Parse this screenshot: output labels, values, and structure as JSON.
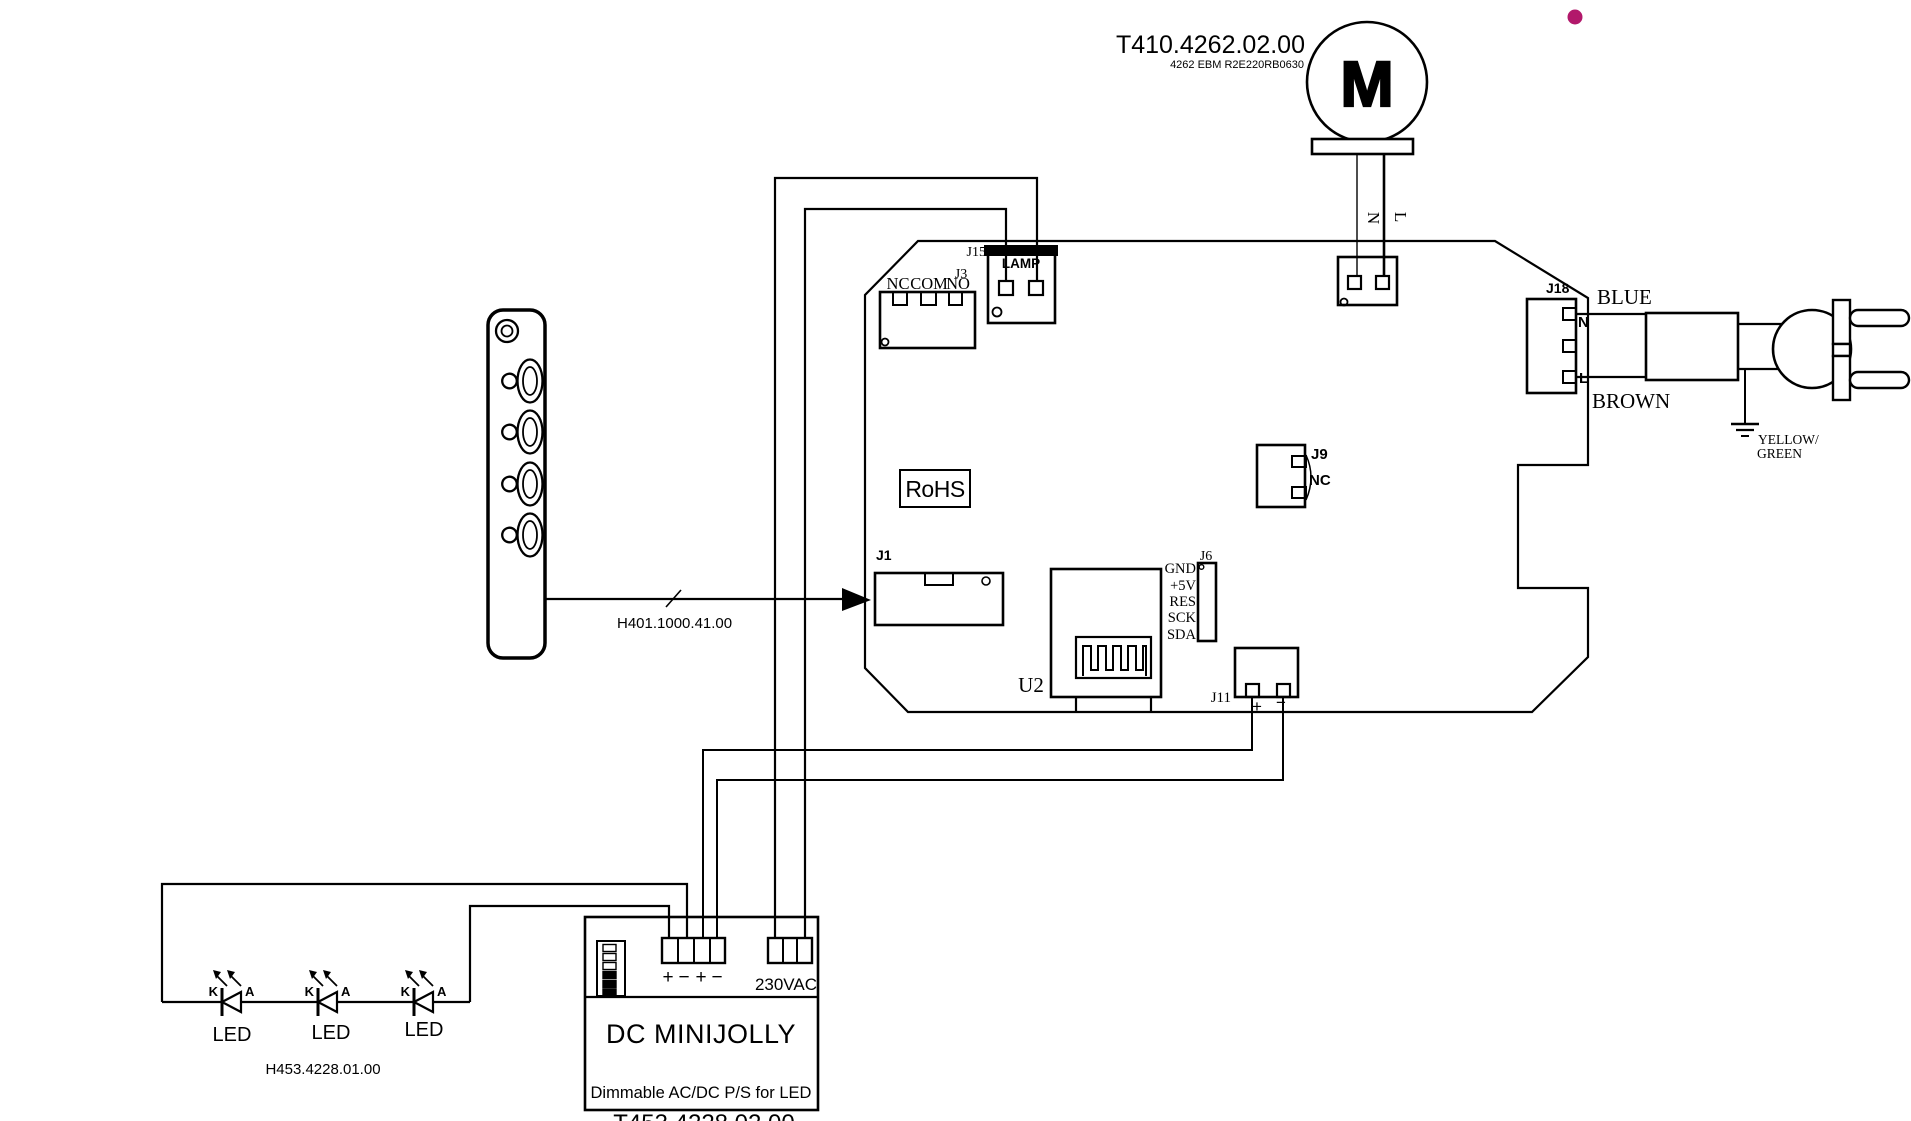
{
  "title": {
    "part_number": "T410.4262.02.00",
    "subtitle": "4262 EBM R2E220RB0630"
  },
  "motor": {
    "symbol": "M",
    "wire_n": "N",
    "wire_l": "L"
  },
  "board": {
    "j15_label": "J15",
    "lamp_label": "LAMP",
    "j3_label": "J3",
    "j3_pins": [
      "NC",
      "COM",
      "NO"
    ],
    "rohs_label": "RoHS",
    "j1_label": "J1",
    "j9_label": "J9",
    "j9_nc_label": "NC",
    "j6_label": "J6",
    "j6_pins": [
      "GND",
      "+5V",
      "RES",
      "SCK",
      "SDA"
    ],
    "u2_label": "U2",
    "j11_label": "J11",
    "j11_plus": "+",
    "j11_minus": "−",
    "j18_label": "J18",
    "j18_n": "N",
    "j18_l": "L"
  },
  "mains": {
    "blue": "BLUE",
    "brown": "BROWN",
    "earth_line1": "YELLOW/",
    "earth_line2": "GREEN"
  },
  "cables": {
    "remote_cable": "H401.1000.41.00",
    "led_cable": "H453.4228.01.00"
  },
  "psu": {
    "name": "DC MINIJOLLY",
    "description": "Dimmable AC/DC P/S for LED",
    "part_number": "T453.4228.02.00",
    "dc_terminals": [
      "+",
      "−",
      "+",
      "−"
    ],
    "ac_label": "230VAC"
  },
  "leds": {
    "label": "LED",
    "cathode": "K",
    "anode": "A"
  },
  "colors": {
    "annotation_dot": "#b2186b",
    "line": "#000000"
  }
}
